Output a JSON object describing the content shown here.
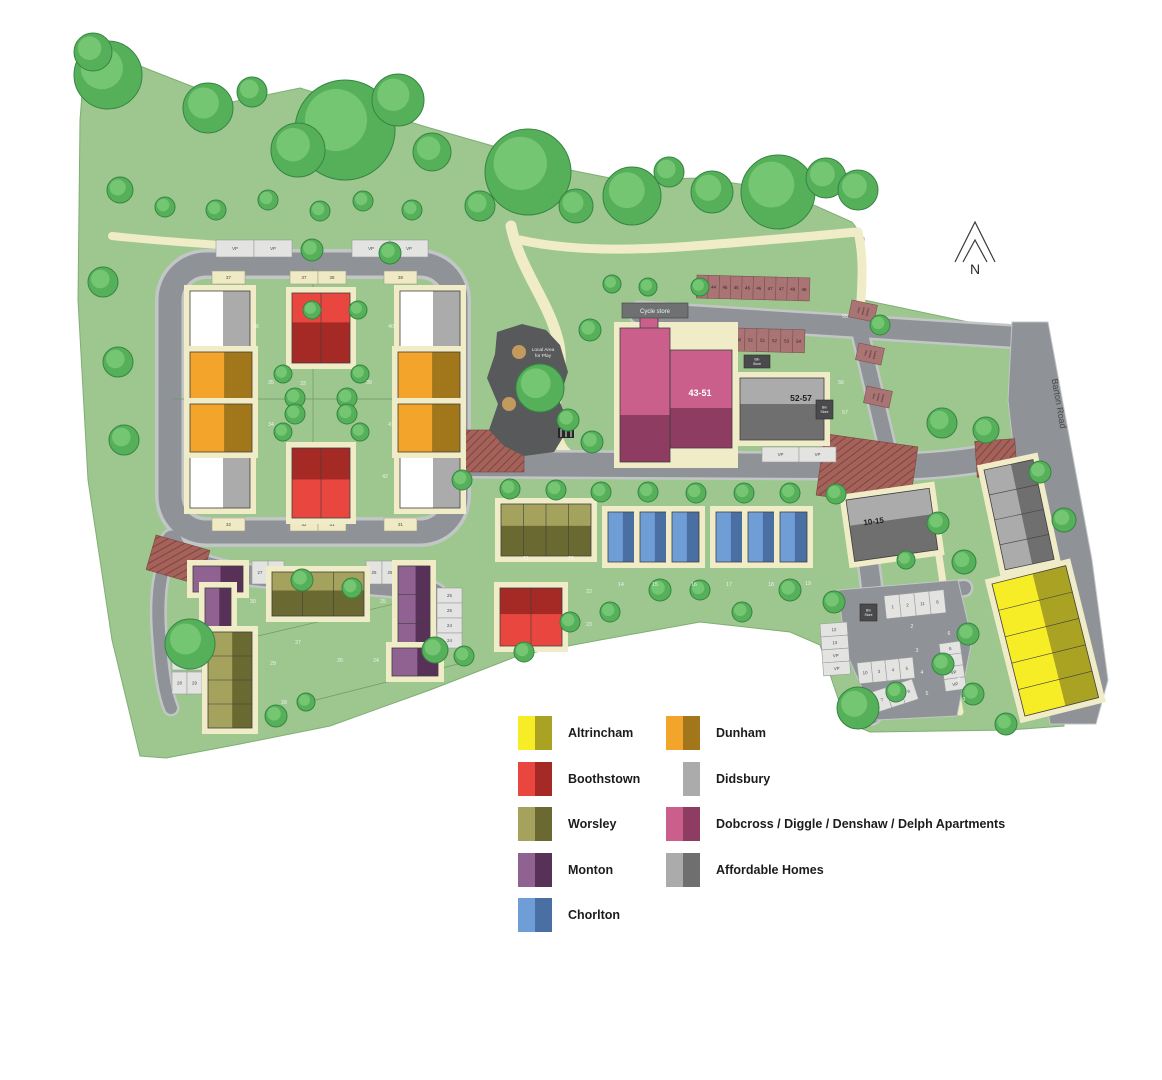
{
  "map": {
    "north_label": "N",
    "road_label": "Barton Road",
    "play_area": {
      "line1": "Local Area",
      "line2": "for Play"
    },
    "cycle_store_label": "Cycle store",
    "bin_store_lines": [
      "Bin",
      "Store"
    ],
    "bin_stores": [
      [
        744,
        355,
        26,
        13
      ],
      [
        816,
        400,
        17,
        19
      ],
      [
        860,
        604,
        17,
        17
      ]
    ],
    "blocks": {
      "b4351": "43-51",
      "b5257": "52-57",
      "b1015": "10-15"
    },
    "visitor_bays": {
      "label_lines": [
        "Elect",
        "Vehicle",
        "Parking"
      ],
      "positions": [
        [
          852,
          300
        ],
        [
          859,
          343
        ],
        [
          867,
          386
        ]
      ]
    },
    "plot_numbers": [
      [
        "36",
        256,
        328
      ],
      [
        "40",
        391,
        328
      ],
      [
        "35",
        271,
        384
      ],
      [
        "33",
        303,
        385
      ],
      [
        "39",
        369,
        384
      ],
      [
        "34",
        271,
        426
      ],
      [
        "41",
        391,
        426
      ],
      [
        "42",
        385,
        478
      ],
      [
        "21",
        526,
        560
      ],
      [
        "20",
        571,
        560
      ],
      [
        "22",
        589,
        593
      ],
      [
        "23",
        589,
        626
      ],
      [
        "14",
        621,
        586
      ],
      [
        "15",
        655,
        586
      ],
      [
        "16",
        694,
        586
      ],
      [
        "17",
        729,
        586
      ],
      [
        "18",
        771,
        586
      ],
      [
        "19",
        808,
        585
      ],
      [
        "30",
        253,
        603
      ],
      [
        "25",
        383,
        603
      ],
      [
        "27",
        298,
        644
      ],
      [
        "26",
        340,
        662
      ],
      [
        "24",
        376,
        662
      ],
      [
        "29",
        273,
        665
      ],
      [
        "28",
        284,
        704
      ],
      [
        "2",
        912,
        628
      ],
      [
        "3",
        917,
        652
      ],
      [
        "4",
        922,
        674
      ],
      [
        "5",
        927,
        695
      ],
      [
        "6",
        949,
        635
      ],
      [
        "7",
        954,
        659
      ],
      [
        "8",
        959,
        681
      ],
      [
        "9",
        964,
        701
      ],
      [
        "55",
        845,
        318
      ],
      [
        "56",
        841,
        384
      ],
      [
        "57",
        845,
        414
      ]
    ],
    "parking_groups": [
      {
        "x": 697,
        "y": 275,
        "cw": 11.3,
        "ch": 23,
        "rot": 1.5,
        "fill": "brown",
        "cells": [
          "43",
          "44",
          "45",
          "45",
          "46",
          "46",
          "47",
          "47",
          "48",
          "48"
        ]
      },
      {
        "x": 697,
        "y": 327,
        "cw": 12,
        "ch": 23,
        "rot": 1.5,
        "fill": "brown",
        "cells": [
          "49",
          "49",
          "50",
          "50",
          "51",
          "51",
          "52",
          "53",
          "54"
        ]
      },
      {
        "x": 216,
        "y": 240,
        "cw": 38,
        "ch": 17,
        "fill": "pale",
        "cells": [
          "VP",
          "VP"
        ]
      },
      {
        "x": 352,
        "y": 240,
        "cw": 38,
        "ch": 17,
        "fill": "pale",
        "cells": [
          "VP",
          "VP"
        ]
      },
      {
        "x": 212,
        "y": 271,
        "cw": 33,
        "ch": 13,
        "fill": "cream",
        "cells": [
          "37"
        ]
      },
      {
        "x": 290,
        "y": 271,
        "cw": 28,
        "ch": 13,
        "fill": "cream",
        "cells": [
          "37",
          "38"
        ]
      },
      {
        "x": 384,
        "y": 271,
        "cw": 33,
        "ch": 13,
        "fill": "cream",
        "cells": [
          "38"
        ]
      },
      {
        "x": 212,
        "y": 518,
        "cw": 33,
        "ch": 13,
        "fill": "cream",
        "cells": [
          "32"
        ]
      },
      {
        "x": 290,
        "y": 518,
        "cw": 28,
        "ch": 13,
        "fill": "cream",
        "cells": [
          "32",
          "31"
        ]
      },
      {
        "x": 384,
        "y": 518,
        "cw": 33,
        "ch": 13,
        "fill": "cream",
        "cells": [
          "31"
        ]
      },
      {
        "x": 652,
        "y": 447,
        "cw": 36,
        "ch": 15,
        "fill": "pale",
        "cells": [
          "43",
          "44"
        ]
      },
      {
        "x": 762,
        "y": 447,
        "cw": 37,
        "ch": 15,
        "fill": "pale",
        "cells": [
          "VP",
          "VP"
        ]
      },
      {
        "x": 252,
        "y": 561,
        "cw": 16,
        "ch": 23,
        "fill": "pale",
        "cells": [
          "27",
          "27"
        ]
      },
      {
        "x": 366,
        "y": 561,
        "cw": 16,
        "ch": 23,
        "fill": "pale",
        "cells": [
          "26",
          "26"
        ]
      },
      {
        "x": 437,
        "y": 588,
        "cw": 25,
        "ch": 15,
        "fill": "pale",
        "vertical": true,
        "cells": [
          "25",
          "25",
          "24",
          "24"
        ]
      },
      {
        "x": 172,
        "y": 648,
        "cw": 15,
        "ch": 22,
        "fill": "pale",
        "cells": [
          "28",
          "29"
        ]
      },
      {
        "x": 172,
        "y": 672,
        "cw": 15,
        "ch": 22,
        "fill": "pale",
        "cells": [
          "28",
          "29"
        ]
      },
      {
        "x": 884,
        "y": 596,
        "cw": 15,
        "ch": 23,
        "rot": -6,
        "fill": "pale",
        "cells": [
          "1",
          "2",
          "11",
          "8"
        ]
      },
      {
        "x": 820,
        "y": 624,
        "cw": 27,
        "ch": 13,
        "rot": -4,
        "fill": "pale",
        "vertical": true,
        "cells": [
          "12",
          "13",
          "VP",
          "VP"
        ]
      },
      {
        "x": 857,
        "y": 663,
        "cw": 14,
        "ch": 21,
        "rot": -6,
        "fill": "pale",
        "cells": [
          "10",
          "3",
          "4",
          "5"
        ]
      },
      {
        "x": 939,
        "y": 644,
        "cw": 21,
        "ch": 12,
        "rot": -8,
        "fill": "pale",
        "vertical": true,
        "cells": [
          "6",
          "6",
          "VP",
          "VP"
        ]
      },
      {
        "x": 872,
        "y": 692,
        "cw": 14,
        "ch": 21,
        "rot": -18,
        "fill": "pale",
        "cells": [
          "7",
          "8",
          "9"
        ]
      }
    ],
    "buildings": [
      {
        "t": "didsbury",
        "x": 190,
        "y": 291,
        "w": 60,
        "h": 56,
        "split": "v"
      },
      {
        "t": "didsbury",
        "x": 400,
        "y": 291,
        "w": 60,
        "h": 56,
        "split": "v"
      },
      {
        "t": "didsbury",
        "x": 190,
        "y": 452,
        "w": 60,
        "h": 56,
        "split": "v"
      },
      {
        "t": "didsbury",
        "x": 400,
        "y": 452,
        "w": 60,
        "h": 56,
        "split": "v"
      },
      {
        "t": "boothstown",
        "x": 292,
        "y": 293,
        "w": 58,
        "h": 70,
        "units": 2,
        "dir": "h",
        "split": "h"
      },
      {
        "t": "boothstown",
        "x": 292,
        "y": 448,
        "w": 58,
        "h": 70,
        "units": 2,
        "dir": "h",
        "split": "hm"
      },
      {
        "t": "dunham",
        "x": 190,
        "y": 352,
        "w": 62,
        "h": 48,
        "split": "v"
      },
      {
        "t": "dunham",
        "x": 190,
        "y": 404,
        "w": 62,
        "h": 48,
        "split": "v"
      },
      {
        "t": "dunham",
        "x": 398,
        "y": 352,
        "w": 62,
        "h": 48,
        "split": "v"
      },
      {
        "t": "dunham",
        "x": 398,
        "y": 404,
        "w": 62,
        "h": 48,
        "split": "v"
      },
      {
        "t": "worsley",
        "x": 501,
        "y": 504,
        "w": 90,
        "h": 52,
        "units": 4,
        "dir": "h",
        "split": "h"
      },
      {
        "t": "boothstown",
        "x": 500,
        "y": 588,
        "w": 62,
        "h": 58,
        "units": 2,
        "dir": "h",
        "split": "hm"
      },
      {
        "t": "chorlton",
        "x": 608,
        "y": 512,
        "w": 27,
        "h": 50,
        "split": "v"
      },
      {
        "t": "chorlton",
        "x": 640,
        "y": 512,
        "w": 27,
        "h": 50,
        "split": "v"
      },
      {
        "t": "chorlton",
        "x": 672,
        "y": 512,
        "w": 27,
        "h": 50,
        "split": "v"
      },
      {
        "t": "chorlton",
        "x": 716,
        "y": 512,
        "w": 27,
        "h": 50,
        "split": "v"
      },
      {
        "t": "chorlton",
        "x": 748,
        "y": 512,
        "w": 27,
        "h": 50,
        "split": "v"
      },
      {
        "t": "chorlton",
        "x": 780,
        "y": 512,
        "w": 27,
        "h": 50,
        "split": "v"
      },
      {
        "t": "monton",
        "x": 193,
        "y": 566,
        "w": 50,
        "h": 26,
        "split": "v"
      },
      {
        "t": "monton",
        "x": 205,
        "y": 588,
        "w": 26,
        "h": 42,
        "split": "v"
      },
      {
        "t": "worsley",
        "x": 272,
        "y": 572,
        "w": 92,
        "h": 44,
        "units": 3,
        "dir": "h",
        "split": "h"
      },
      {
        "t": "monton",
        "x": 398,
        "y": 566,
        "w": 32,
        "h": 86,
        "units": 3,
        "dir": "v",
        "split": "v"
      },
      {
        "t": "monton",
        "x": 392,
        "y": 648,
        "w": 46,
        "h": 28,
        "split": "v"
      },
      {
        "t": "worsley",
        "x": 208,
        "y": 632,
        "w": 44,
        "h": 96,
        "units": 4,
        "dir": "v",
        "split": "v"
      },
      {
        "t": "affordable",
        "x": 740,
        "y": 378,
        "w": 84,
        "h": 62,
        "split": "h"
      },
      {
        "t": "affordable",
        "x": 846,
        "y": 500,
        "w": 84,
        "h": 62,
        "rot": -8,
        "split": "h"
      },
      {
        "t": "affordable",
        "x": 984,
        "y": 470,
        "w": 50,
        "h": 102,
        "rot": -12,
        "units": 4,
        "dir": "v",
        "split": "v"
      },
      {
        "t": "altrincham",
        "x": 992,
        "y": 584,
        "w": 76,
        "h": 136,
        "rot": -14,
        "units": 5,
        "dir": "v",
        "split": "v"
      }
    ],
    "trees": [
      [
        108,
        75,
        34
      ],
      [
        93,
        52,
        19
      ],
      [
        208,
        108,
        25
      ],
      [
        252,
        92,
        15
      ],
      [
        345,
        130,
        50
      ],
      [
        298,
        150,
        27
      ],
      [
        398,
        100,
        26
      ],
      [
        432,
        152,
        19
      ],
      [
        528,
        172,
        43
      ],
      [
        480,
        206,
        15
      ],
      [
        576,
        206,
        17
      ],
      [
        632,
        196,
        29
      ],
      [
        669,
        172,
        15
      ],
      [
        712,
        192,
        21
      ],
      [
        778,
        192,
        37
      ],
      [
        826,
        178,
        20
      ],
      [
        858,
        190,
        20
      ],
      [
        120,
        190,
        13
      ],
      [
        103,
        282,
        15
      ],
      [
        118,
        362,
        15
      ],
      [
        124,
        440,
        15
      ],
      [
        190,
        644,
        25
      ],
      [
        276,
        716,
        11
      ],
      [
        306,
        702,
        9
      ],
      [
        165,
        207,
        10
      ],
      [
        216,
        210,
        10
      ],
      [
        268,
        200,
        10
      ],
      [
        320,
        211,
        10
      ],
      [
        363,
        201,
        10
      ],
      [
        412,
        210,
        10
      ],
      [
        312,
        250,
        11
      ],
      [
        390,
        253,
        11
      ],
      [
        283,
        374,
        9
      ],
      [
        295,
        398,
        10
      ],
      [
        295,
        414,
        10
      ],
      [
        283,
        432,
        9
      ],
      [
        360,
        374,
        9
      ],
      [
        347,
        398,
        10
      ],
      [
        347,
        414,
        10
      ],
      [
        360,
        432,
        9
      ],
      [
        312,
        310,
        9
      ],
      [
        358,
        310,
        9
      ],
      [
        462,
        480,
        10
      ],
      [
        510,
        489,
        10
      ],
      [
        556,
        490,
        10
      ],
      [
        601,
        492,
        10
      ],
      [
        648,
        492,
        10
      ],
      [
        696,
        493,
        10
      ],
      [
        744,
        493,
        10
      ],
      [
        790,
        493,
        10
      ],
      [
        836,
        494,
        10
      ],
      [
        540,
        388,
        24
      ],
      [
        568,
        420,
        11
      ],
      [
        592,
        442,
        11
      ],
      [
        590,
        330,
        11
      ],
      [
        612,
        284,
        9
      ],
      [
        648,
        287,
        9
      ],
      [
        700,
        287,
        9
      ],
      [
        880,
        325,
        10
      ],
      [
        942,
        423,
        15
      ],
      [
        986,
        430,
        13
      ],
      [
        938,
        523,
        11
      ],
      [
        964,
        562,
        12
      ],
      [
        906,
        560,
        9
      ],
      [
        1040,
        472,
        11
      ],
      [
        1064,
        520,
        12
      ],
      [
        302,
        580,
        11
      ],
      [
        352,
        588,
        10
      ],
      [
        435,
        650,
        13
      ],
      [
        464,
        656,
        10
      ],
      [
        524,
        652,
        10
      ],
      [
        570,
        622,
        10
      ],
      [
        610,
        612,
        10
      ],
      [
        660,
        590,
        11
      ],
      [
        700,
        590,
        10
      ],
      [
        742,
        612,
        10
      ],
      [
        790,
        590,
        11
      ],
      [
        834,
        602,
        11
      ],
      [
        968,
        634,
        11
      ],
      [
        943,
        664,
        11
      ],
      [
        973,
        694,
        11
      ],
      [
        1006,
        724,
        11
      ],
      [
        858,
        708,
        21
      ],
      [
        896,
        692,
        10
      ]
    ],
    "palette": {
      "grass": "#9dc78f",
      "road": "#8f9296",
      "path_cream": "#f1ecc8",
      "bay_brown": "#aa7474",
      "bay_pale": "#e3e4e2",
      "bay_cream": "#efe9c4",
      "play_area": "#58595b",
      "hatch_red": "#a5625b",
      "tree_fill": "#55b059",
      "tree_edge": "#358543",
      "tree_light": "#74c673"
    }
  },
  "legend": {
    "items": [
      {
        "key": "altrincham",
        "label": "Altrincham",
        "light": "#f6ed26",
        "dark": "#a9a223"
      },
      {
        "key": "boothstown",
        "label": "Boothstown",
        "light": "#e9463f",
        "dark": "#a52a26"
      },
      {
        "key": "worsley",
        "label": "Worsley",
        "light": "#a4a25c",
        "dark": "#6a6931"
      },
      {
        "key": "monton",
        "label": "Monton",
        "light": "#8f6292",
        "dark": "#583158"
      },
      {
        "key": "chorlton",
        "label": "Chorlton",
        "light": "#6f9ed6",
        "dark": "#4a6fa3"
      },
      {
        "key": "dunham",
        "label": "Dunham",
        "light": "#f2a52a",
        "dark": "#a2771b"
      },
      {
        "key": "didsbury",
        "label": "Didsbury",
        "light": "#ffffff",
        "dark": "#ababab"
      },
      {
        "key": "dobcross",
        "label": "Dobcross / Diggle / Denshaw / Delph Apartments",
        "light": "#cb5f8c",
        "dark": "#8e3c62"
      },
      {
        "key": "affordable",
        "label": "Affordable Homes",
        "light": "#ababab",
        "dark": "#6f6f6f"
      }
    ]
  }
}
